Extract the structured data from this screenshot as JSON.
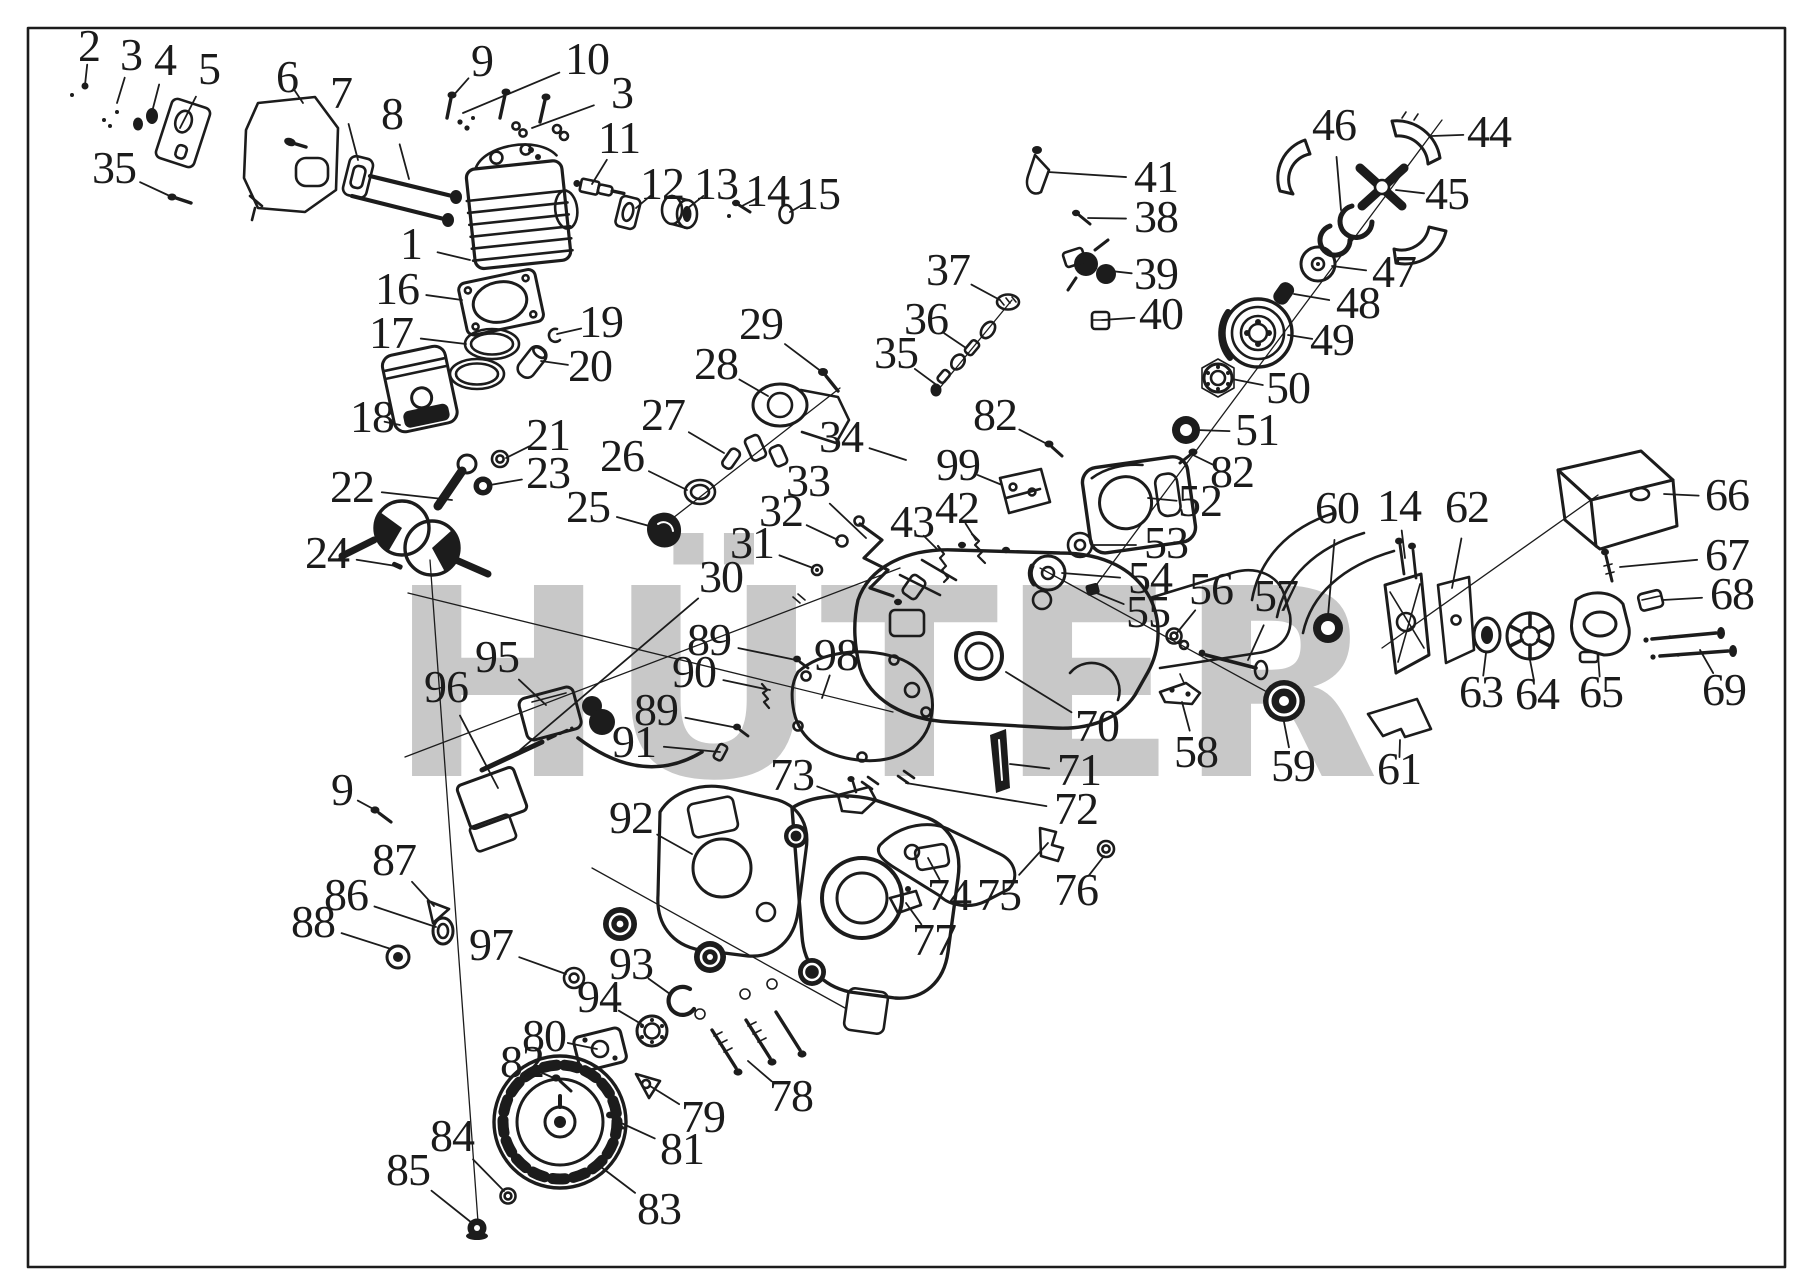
{
  "diagram": {
    "type": "exploded-parts-diagram",
    "subject": "chainsaw engine parts",
    "background": "#ffffff",
    "frame": {
      "x": 28,
      "y": 28,
      "width": 1757,
      "height": 1239,
      "color": "#1b1b1b"
    },
    "watermark": {
      "text": "HÜTER",
      "text_color": "#c8c8c8",
      "logo_colors": {
        "gray": "#c6c6c6",
        "red": "#f3aab2",
        "yellow": "#f5f0b0"
      }
    },
    "labels": [
      {
        "n": "2",
        "x": 89,
        "y": 48,
        "tx": 85,
        "ty": 85
      },
      {
        "n": "3",
        "x": 131,
        "y": 57,
        "tx": 117,
        "ty": 103
      },
      {
        "n": "4",
        "x": 165,
        "y": 62,
        "tx": 152,
        "ty": 112
      },
      {
        "n": "5",
        "x": 209,
        "y": 71,
        "tx": 180,
        "ty": 128
      },
      {
        "n": "6",
        "x": 287,
        "y": 79,
        "tx": 303,
        "ty": 103
      },
      {
        "n": "7",
        "x": 341,
        "y": 95,
        "tx": 358,
        "ty": 160
      },
      {
        "n": "8",
        "x": 392,
        "y": 116,
        "tx": 409,
        "ty": 179
      },
      {
        "n": "35",
        "x": 114,
        "y": 170,
        "tx": 172,
        "ty": 197
      },
      {
        "n": "9",
        "x": 482,
        "y": 63,
        "tx": 452,
        "ty": 97
      },
      {
        "n": "10",
        "x": 587,
        "y": 61,
        "tx": 463,
        "ty": 113
      },
      {
        "n": "3",
        "x": 622,
        "y": 95,
        "tx": 532,
        "ty": 128
      },
      {
        "n": "11",
        "x": 619,
        "y": 140,
        "tx": 592,
        "ty": 184
      },
      {
        "n": "12",
        "x": 662,
        "y": 186,
        "tx": 636,
        "ty": 208
      },
      {
        "n": "13",
        "x": 716,
        "y": 186,
        "tx": 688,
        "ty": 208
      },
      {
        "n": "14",
        "x": 767,
        "y": 193,
        "tx": 742,
        "ty": 206
      },
      {
        "n": "15",
        "x": 818,
        "y": 196,
        "tx": 790,
        "ty": 212
      },
      {
        "n": "1",
        "x": 411,
        "y": 246,
        "tx": 470,
        "ty": 260
      },
      {
        "n": "16",
        "x": 397,
        "y": 291,
        "tx": 462,
        "ty": 300
      },
      {
        "n": "17",
        "x": 391,
        "y": 335,
        "tx": 466,
        "ty": 344
      },
      {
        "n": "18",
        "x": 372,
        "y": 419,
        "tx": 400,
        "ty": 425
      },
      {
        "n": "19",
        "x": 601,
        "y": 324,
        "tx": 557,
        "ty": 334
      },
      {
        "n": "20",
        "x": 590,
        "y": 368,
        "tx": 541,
        "ty": 361
      },
      {
        "n": "21",
        "x": 548,
        "y": 437,
        "tx": 506,
        "ty": 458
      },
      {
        "n": "23",
        "x": 548,
        "y": 475,
        "tx": 490,
        "ty": 485
      },
      {
        "n": "22",
        "x": 352,
        "y": 489,
        "tx": 452,
        "ty": 500
      },
      {
        "n": "24",
        "x": 327,
        "y": 555,
        "tx": 396,
        "ty": 566
      },
      {
        "n": "25",
        "x": 588,
        "y": 509,
        "tx": 653,
        "ty": 527
      },
      {
        "n": "26",
        "x": 622,
        "y": 458,
        "tx": 687,
        "ty": 490
      },
      {
        "n": "27",
        "x": 663,
        "y": 417,
        "tx": 724,
        "ty": 453
      },
      {
        "n": "28",
        "x": 716,
        "y": 366,
        "tx": 768,
        "ty": 396
      },
      {
        "n": "29",
        "x": 761,
        "y": 326,
        "tx": 826,
        "ty": 375
      },
      {
        "n": "34",
        "x": 841,
        "y": 439,
        "tx": 906,
        "ty": 460
      },
      {
        "n": "33",
        "x": 808,
        "y": 483,
        "tx": 866,
        "ty": 538
      },
      {
        "n": "32",
        "x": 781,
        "y": 513,
        "tx": 838,
        "ty": 540
      },
      {
        "n": "31",
        "x": 752,
        "y": 545,
        "tx": 813,
        "ty": 568
      },
      {
        "n": "30",
        "x": 721,
        "y": 579,
        "tx": 520,
        "ty": 750
      },
      {
        "n": "43",
        "x": 912,
        "y": 524,
        "tx": 938,
        "ty": 550
      },
      {
        "n": "42",
        "x": 957,
        "y": 510,
        "tx": 976,
        "ty": 540
      },
      {
        "n": "99",
        "x": 958,
        "y": 467,
        "tx": 1002,
        "ty": 485
      },
      {
        "n": "82",
        "x": 995,
        "y": 417,
        "tx": 1049,
        "ty": 445
      },
      {
        "n": "36",
        "x": 926,
        "y": 321,
        "tx": 966,
        "ty": 348
      },
      {
        "n": "35",
        "x": 896,
        "y": 355,
        "tx": 938,
        "ty": 386
      },
      {
        "n": "37",
        "x": 948,
        "y": 272,
        "tx": 1000,
        "ty": 300
      },
      {
        "n": "41",
        "x": 1156,
        "y": 179,
        "tx": 1048,
        "ty": 172
      },
      {
        "n": "38",
        "x": 1156,
        "y": 219,
        "tx": 1088,
        "ty": 218
      },
      {
        "n": "39",
        "x": 1156,
        "y": 276,
        "tx": 1102,
        "ty": 270
      },
      {
        "n": "40",
        "x": 1161,
        "y": 316,
        "tx": 1102,
        "ty": 320
      },
      {
        "n": "46",
        "x": 1334,
        "y": 127,
        "tx": 1341,
        "ty": 210
      },
      {
        "n": "44",
        "x": 1489,
        "y": 134,
        "tx": 1432,
        "ty": 136
      },
      {
        "n": "45",
        "x": 1447,
        "y": 196,
        "tx": 1396,
        "ty": 190
      },
      {
        "n": "47",
        "x": 1394,
        "y": 274,
        "tx": 1332,
        "ty": 266
      },
      {
        "n": "48",
        "x": 1358,
        "y": 305,
        "tx": 1294,
        "ty": 294
      },
      {
        "n": "49",
        "x": 1332,
        "y": 342,
        "tx": 1288,
        "ty": 335
      },
      {
        "n": "50",
        "x": 1288,
        "y": 390,
        "tx": 1232,
        "ty": 379
      },
      {
        "n": "51",
        "x": 1257,
        "y": 432,
        "tx": 1196,
        "ty": 430
      },
      {
        "n": "82",
        "x": 1232,
        "y": 474,
        "tx": 1193,
        "ty": 455
      },
      {
        "n": "52",
        "x": 1200,
        "y": 503,
        "tx": 1148,
        "ty": 498
      },
      {
        "n": "53",
        "x": 1166,
        "y": 545,
        "tx": 1092,
        "ty": 545
      },
      {
        "n": "54",
        "x": 1150,
        "y": 580,
        "tx": 1062,
        "ty": 573
      },
      {
        "n": "55",
        "x": 1148,
        "y": 614,
        "tx": 1094,
        "ty": 592
      },
      {
        "n": "56",
        "x": 1211,
        "y": 591,
        "tx": 1176,
        "ty": 634
      },
      {
        "n": "57",
        "x": 1276,
        "y": 598,
        "tx": 1248,
        "ty": 660
      },
      {
        "n": "60",
        "x": 1337,
        "y": 510,
        "tx": 1328,
        "ty": 616
      },
      {
        "n": "14",
        "x": 1399,
        "y": 508,
        "tx": 1405,
        "ty": 558
      },
      {
        "n": "62",
        "x": 1467,
        "y": 509,
        "tx": 1452,
        "ty": 588
      },
      {
        "n": "66",
        "x": 1727,
        "y": 497,
        "tx": 1664,
        "ty": 494
      },
      {
        "n": "67",
        "x": 1727,
        "y": 557,
        "tx": 1620,
        "ty": 567
      },
      {
        "n": "68",
        "x": 1732,
        "y": 596,
        "tx": 1663,
        "ty": 600
      },
      {
        "n": "69",
        "x": 1724,
        "y": 692,
        "tx": 1700,
        "ty": 650
      },
      {
        "n": "63",
        "x": 1481,
        "y": 694,
        "tx": 1486,
        "ty": 653
      },
      {
        "n": "64",
        "x": 1537,
        "y": 696,
        "tx": 1530,
        "ty": 660
      },
      {
        "n": "65",
        "x": 1601,
        "y": 694,
        "tx": 1598,
        "ty": 655
      },
      {
        "n": "61",
        "x": 1399,
        "y": 771,
        "tx": 1400,
        "ty": 740
      },
      {
        "n": "58",
        "x": 1196,
        "y": 754,
        "tx": 1182,
        "ty": 702
      },
      {
        "n": "59",
        "x": 1293,
        "y": 768,
        "tx": 1284,
        "ty": 722
      },
      {
        "n": "70",
        "x": 1097,
        "y": 728,
        "tx": 1006,
        "ty": 672
      },
      {
        "n": "71",
        "x": 1079,
        "y": 772,
        "tx": 1010,
        "ty": 764
      },
      {
        "n": "72",
        "x": 1076,
        "y": 811,
        "tx": 906,
        "ty": 783
      },
      {
        "n": "98",
        "x": 836,
        "y": 657,
        "tx": 822,
        "ty": 698
      },
      {
        "n": "89",
        "x": 709,
        "y": 642,
        "tx": 796,
        "ty": 660
      },
      {
        "n": "90",
        "x": 694,
        "y": 674,
        "tx": 770,
        "ty": 690
      },
      {
        "n": "89",
        "x": 656,
        "y": 712,
        "tx": 738,
        "ty": 728
      },
      {
        "n": "91",
        "x": 634,
        "y": 744,
        "tx": 720,
        "ty": 752
      },
      {
        "n": "73",
        "x": 792,
        "y": 777,
        "tx": 848,
        "ty": 798
      },
      {
        "n": "74",
        "x": 949,
        "y": 897,
        "tx": 928,
        "ty": 858
      },
      {
        "n": "75",
        "x": 999,
        "y": 897,
        "tx": 1048,
        "ty": 843
      },
      {
        "n": "76",
        "x": 1076,
        "y": 892,
        "tx": 1104,
        "ty": 856
      },
      {
        "n": "77",
        "x": 934,
        "y": 942,
        "tx": 906,
        "ty": 903
      },
      {
        "n": "92",
        "x": 631,
        "y": 820,
        "tx": 692,
        "ty": 854
      },
      {
        "n": "95",
        "x": 497,
        "y": 659,
        "tx": 546,
        "ty": 705
      },
      {
        "n": "96",
        "x": 446,
        "y": 689,
        "tx": 498,
        "ty": 788
      },
      {
        "n": "9",
        "x": 342,
        "y": 792,
        "tx": 377,
        "ty": 811
      },
      {
        "n": "87",
        "x": 394,
        "y": 862,
        "tx": 434,
        "ty": 906
      },
      {
        "n": "86",
        "x": 346,
        "y": 897,
        "tx": 436,
        "ty": 927
      },
      {
        "n": "88",
        "x": 313,
        "y": 924,
        "tx": 391,
        "ty": 949
      },
      {
        "n": "97",
        "x": 491,
        "y": 947,
        "tx": 566,
        "ty": 974
      },
      {
        "n": "93",
        "x": 631,
        "y": 966,
        "tx": 670,
        "ty": 994
      },
      {
        "n": "94",
        "x": 599,
        "y": 999,
        "tx": 643,
        "ty": 1025
      },
      {
        "n": "80",
        "x": 544,
        "y": 1038,
        "tx": 597,
        "ty": 1049
      },
      {
        "n": "82",
        "x": 522,
        "y": 1064,
        "tx": 556,
        "ty": 1079
      },
      {
        "n": "79",
        "x": 703,
        "y": 1119,
        "tx": 650,
        "ty": 1086
      },
      {
        "n": "81",
        "x": 682,
        "y": 1151,
        "tx": 619,
        "ty": 1122
      },
      {
        "n": "78",
        "x": 791,
        "y": 1098,
        "tx": 748,
        "ty": 1061
      },
      {
        "n": "83",
        "x": 659,
        "y": 1211,
        "tx": 601,
        "ty": 1167
      },
      {
        "n": "84",
        "x": 452,
        "y": 1138,
        "tx": 504,
        "ty": 1191
      },
      {
        "n": "85",
        "x": 408,
        "y": 1172,
        "tx": 472,
        "ty": 1223
      }
    ]
  }
}
